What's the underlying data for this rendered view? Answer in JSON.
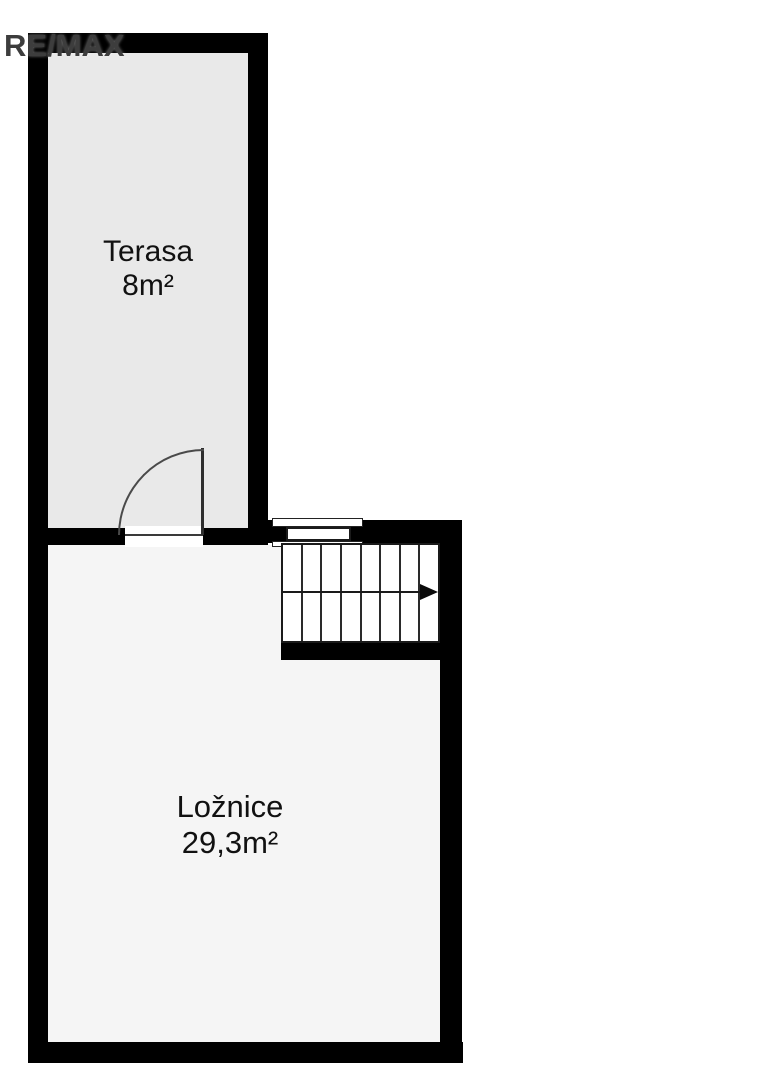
{
  "logo": {
    "text": "RE/MAX",
    "color": "#3d3d3d"
  },
  "rooms": {
    "terasa": {
      "name": "Terasa",
      "area": "8m²"
    },
    "loznice": {
      "name": "Ložnice",
      "area": "29,3m²"
    }
  },
  "stairs": {
    "steps": 8,
    "direction": "right"
  },
  "symbols": {
    "door": "quarter-circle swing door between Terasa and Ložnice",
    "window": "window in stairwell top wall"
  },
  "colors": {
    "wall": "#000000",
    "terasa_fill": "#e9e9e9",
    "loznice_fill": "#f5f5f5",
    "line": "#2e2e2e",
    "background": "#ffffff"
  }
}
